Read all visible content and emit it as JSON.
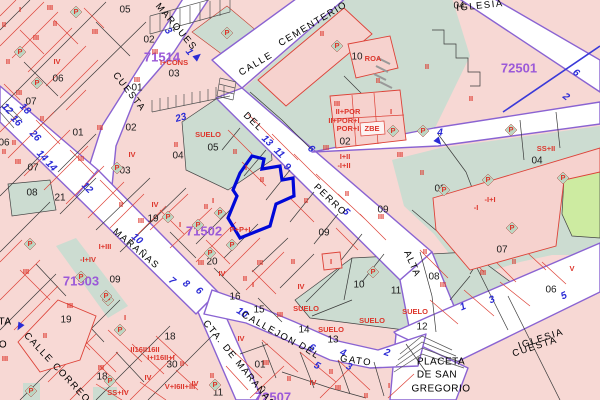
{
  "map": {
    "colors": {
      "parcel_pink": "#f7d8d4",
      "building_pink": "#f6d2ce",
      "parcel_green": "#ccdcd1",
      "bright_green": "#cdeba1",
      "street_white": "#ffffff",
      "street_purple": "#8a63d2",
      "line_red": "#dd4238",
      "line_black": "#3a3a3a",
      "portal_blue": "#2b2bd5",
      "block_purple": "#9b59d8",
      "selected_blue": "#0008d8",
      "label_red": "#dd362c",
      "label_black": "#1c1c1c"
    },
    "selected_parcel": {
      "number": "07"
    },
    "block_ids": [
      [
        "71514",
        162,
        58
      ],
      [
        "72501",
        519,
        69
      ],
      [
        "71502",
        204,
        232
      ],
      [
        "71503",
        81,
        282
      ],
      [
        "72507",
        273,
        398
      ]
    ],
    "street_names": [
      [
        "MARQUES",
        176,
        27,
        50,
        3
      ],
      [
        "CALLE",
        256,
        64,
        -31,
        2
      ],
      [
        "CEMENTERIO",
        313,
        24,
        -31,
        2
      ],
      [
        "CUESTA",
        129,
        92,
        52,
        1
      ],
      [
        "DEL",
        253,
        122,
        44,
        1
      ],
      [
        "PERRO",
        330,
        200,
        44,
        1
      ],
      [
        "MARAÑAS",
        136,
        249,
        40,
        1
      ],
      [
        "CALLE CORREO",
        57,
        368,
        47,
        1
      ],
      [
        "CALLEJON",
        269,
        329,
        29,
        1
      ],
      [
        "DEL",
        309,
        351,
        33,
        1
      ],
      [
        "GATO",
        356,
        361,
        8,
        1
      ],
      [
        "CTA. DE MARAÑAS",
        239,
        364,
        51,
        0
      ],
      [
        "ALTA",
        412,
        264,
        66,
        1
      ],
      [
        "CUESTA",
        535,
        347,
        -18,
        1
      ],
      [
        "IGLESIA",
        541,
        339,
        -18,
        0
      ],
      [
        "IGLESIA",
        480,
        6,
        -6,
        1
      ]
    ],
    "place_labels": [
      [
        "PLACETA",
        441,
        362
      ],
      [
        "DE SAN",
        437,
        375
      ],
      [
        "GREGORIO",
        441,
        389
      ],
      [
        "TA",
        5,
        322
      ],
      [
        "O",
        3,
        345
      ]
    ],
    "parcel_numbers": [
      [
        "05",
        125,
        10
      ],
      [
        "02",
        149,
        40
      ],
      [
        "03",
        174,
        74
      ],
      [
        "01",
        137,
        88
      ],
      [
        "06",
        58,
        79
      ],
      [
        "07",
        31,
        102
      ],
      [
        "06",
        4,
        143
      ],
      [
        "07",
        33,
        168
      ],
      [
        "01",
        78,
        133
      ],
      [
        "02",
        131,
        128
      ],
      [
        "03",
        125,
        171
      ],
      [
        "04",
        178,
        156
      ],
      [
        "08",
        32,
        193
      ],
      [
        "21",
        60,
        198
      ],
      [
        "19",
        153,
        219
      ],
      [
        "04",
        459,
        6
      ],
      [
        "10",
        357,
        57
      ],
      [
        "02",
        345,
        142
      ],
      [
        "03",
        440,
        189
      ],
      [
        "04",
        537,
        161
      ],
      [
        "07",
        502,
        250
      ],
      [
        "08",
        434,
        277
      ],
      [
        "06",
        551,
        290
      ],
      [
        "12",
        422,
        327
      ],
      [
        "09",
        115,
        280
      ],
      [
        "09",
        324,
        233
      ],
      [
        "09",
        383,
        210
      ],
      [
        "20",
        212,
        262
      ],
      [
        "16",
        235,
        297
      ],
      [
        "15",
        259,
        310
      ],
      [
        "14",
        304,
        330
      ],
      [
        "13",
        333,
        340
      ],
      [
        "10",
        359,
        285
      ],
      [
        "11",
        396,
        291
      ],
      [
        "01",
        260,
        365
      ],
      [
        "19",
        66,
        320
      ],
      [
        "18",
        102,
        377
      ],
      [
        "18",
        170,
        337
      ],
      [
        "30",
        172,
        365
      ],
      [
        "11",
        218,
        393
      ],
      [
        "05",
        213,
        148
      ]
    ],
    "street_numbers": [
      [
        "3",
        168,
        31,
        50
      ],
      [
        "1",
        189,
        52,
        50
      ],
      [
        "23",
        181,
        118,
        -15
      ],
      [
        "12",
        7,
        109,
        45
      ],
      [
        "18",
        25,
        109,
        45
      ],
      [
        "16",
        16,
        121,
        45
      ],
      [
        "26",
        35,
        136,
        45
      ],
      [
        "14",
        42,
        156,
        45
      ],
      [
        "14",
        51,
        166,
        45
      ],
      [
        "12",
        87,
        188,
        45
      ],
      [
        "13",
        267,
        141,
        44
      ],
      [
        "11",
        279,
        153,
        44
      ],
      [
        "9",
        287,
        167,
        44
      ],
      [
        "6",
        311,
        149,
        44
      ],
      [
        "5",
        346,
        212,
        44
      ],
      [
        "4",
        440,
        133,
        0
      ],
      [
        "6",
        576,
        73,
        38
      ],
      [
        "2",
        566,
        97,
        38
      ],
      [
        "10",
        137,
        239,
        40
      ],
      [
        "7",
        172,
        281,
        40
      ],
      [
        "8",
        186,
        284,
        40
      ],
      [
        "6",
        199,
        291,
        40
      ],
      [
        "10",
        242,
        313,
        32
      ],
      [
        "6",
        312,
        348,
        28
      ],
      [
        "5",
        317,
        366,
        28
      ],
      [
        "4",
        343,
        353,
        22
      ],
      [
        "3",
        349,
        367,
        22
      ],
      [
        "2",
        387,
        353,
        18
      ],
      [
        "1",
        463,
        307,
        -22
      ],
      [
        "3",
        492,
        300,
        -22
      ],
      [
        "5",
        564,
        296,
        -25
      ]
    ],
    "building_labels": [
      [
        "I",
        20,
        10
      ],
      [
        "III",
        50,
        8
      ],
      [
        "II",
        4,
        25
      ],
      [
        "II",
        55,
        24
      ],
      [
        "III",
        36,
        38
      ],
      [
        "III",
        95,
        32
      ],
      [
        "II",
        8,
        62
      ],
      [
        "IV",
        57,
        62
      ],
      [
        "P",
        76,
        12
      ],
      [
        "P",
        20,
        52
      ],
      [
        "P",
        37,
        83
      ],
      [
        "III",
        19,
        93
      ],
      [
        "II",
        42,
        119
      ],
      [
        "III",
        100,
        128
      ],
      [
        "II",
        14,
        143
      ],
      [
        "II",
        4,
        152
      ],
      [
        "III",
        18,
        162
      ],
      [
        "III",
        81,
        159
      ],
      [
        "IV",
        132,
        155
      ],
      [
        "P",
        117,
        168
      ],
      [
        "III",
        155,
        52
      ],
      [
        "I+CONS",
        174,
        63
      ],
      [
        "III",
        137,
        80
      ],
      [
        "P",
        227,
        33
      ],
      [
        "II",
        322,
        34
      ],
      [
        "P",
        337,
        46
      ],
      [
        "ROA",
        373,
        59
      ],
      [
        "II",
        378,
        81
      ],
      [
        "II",
        427,
        67
      ],
      [
        "II",
        471,
        99
      ],
      [
        "III",
        337,
        104
      ],
      [
        "II+POR",
        348,
        112
      ],
      [
        "II+POR+I",
        344,
        121
      ],
      [
        "POR+I",
        348,
        129
      ],
      [
        "ZBE",
        372,
        129,
        6
      ],
      [
        "P",
        393,
        131
      ],
      [
        "I",
        391,
        112
      ],
      [
        "I+II",
        345,
        157
      ],
      [
        "-I+II",
        344,
        166
      ],
      [
        "III",
        326,
        148
      ],
      [
        "III",
        400,
        155
      ],
      [
        "II",
        422,
        173
      ],
      [
        "SUELO",
        208,
        135
      ],
      [
        "II",
        176,
        145
      ],
      [
        "II",
        235,
        152
      ],
      [
        "I",
        246,
        168
      ],
      [
        "II",
        262,
        180
      ],
      [
        "II",
        306,
        201
      ],
      [
        "II",
        347,
        194
      ],
      [
        "I",
        213,
        201
      ],
      [
        "P",
        220,
        213
      ],
      [
        "P",
        198,
        225
      ],
      [
        "P+P+I",
        240,
        230
      ],
      [
        "P",
        232,
        245
      ],
      [
        "P",
        210,
        253
      ],
      [
        "II",
        121,
        205
      ],
      [
        "IV",
        155,
        205
      ],
      [
        "II",
        206,
        207
      ],
      [
        "III",
        141,
        221
      ],
      [
        "P",
        168,
        217
      ],
      [
        "I",
        180,
        225
      ],
      [
        "III",
        201,
        263
      ],
      [
        "III",
        260,
        263
      ],
      [
        "IV",
        222,
        274
      ],
      [
        "II",
        245,
        279
      ],
      [
        "I",
        253,
        285
      ],
      [
        "I+III",
        105,
        247
      ],
      [
        "-I+IV",
        88,
        260
      ],
      [
        "III",
        26,
        272
      ],
      [
        "III",
        70,
        306
      ],
      [
        "P",
        30,
        244
      ],
      [
        "P",
        81,
        277
      ],
      [
        "P",
        108,
        300
      ],
      [
        "I",
        125,
        318
      ],
      [
        "P",
        120,
        330
      ],
      [
        "II",
        45,
        336
      ],
      [
        "III",
        101,
        368
      ],
      [
        "P",
        110,
        381
      ],
      [
        "SS+IV",
        118,
        393,
        6
      ],
      [
        "IV",
        148,
        378
      ],
      [
        "II16II16II",
        145,
        350,
        5
      ],
      [
        "I+I16II+I",
        161,
        358,
        5
      ],
      [
        "V+I6II+III",
        180,
        387,
        5
      ],
      [
        "II",
        182,
        364
      ],
      [
        "P",
        106,
        296
      ],
      [
        "P",
        31,
        391
      ],
      [
        "III",
        5,
        359
      ],
      [
        "II",
        293,
        262
      ],
      [
        "I",
        331,
        262
      ],
      [
        "IV",
        301,
        287
      ],
      [
        "III",
        280,
        315
      ],
      [
        "SUELO",
        306,
        309
      ],
      [
        "SUELO",
        331,
        330
      ],
      [
        "SUELO",
        372,
        321
      ],
      [
        "SUELO",
        415,
        312
      ],
      [
        "P",
        373,
        272
      ],
      [
        "III",
        266,
        363
      ],
      [
        "IV",
        241,
        339
      ],
      [
        "II",
        212,
        376
      ],
      [
        "IV",
        195,
        384
      ],
      [
        "P",
        215,
        385
      ],
      [
        "II",
        289,
        379
      ],
      [
        "IV",
        313,
        383
      ],
      [
        "III",
        338,
        388
      ],
      [
        "II",
        366,
        396
      ],
      [
        "I",
        389,
        386
      ],
      [
        "II",
        331,
        372
      ],
      [
        "III",
        381,
        217
      ],
      [
        "II",
        425,
        252
      ],
      [
        "III",
        443,
        285
      ],
      [
        "III",
        483,
        273
      ],
      [
        "II",
        514,
        262
      ],
      [
        "V",
        572,
        269
      ],
      [
        "-I",
        476,
        208,
        6
      ],
      [
        "-I+I",
        490,
        200,
        6
      ],
      [
        "P",
        444,
        190
      ],
      [
        "P",
        488,
        180
      ],
      [
        "P",
        511,
        130
      ],
      [
        "P",
        563,
        178
      ],
      [
        "P",
        512,
        228
      ],
      [
        "SS+II",
        546,
        149
      ],
      [
        "P",
        423,
        131
      ]
    ],
    "arrows": [
      [
        197,
        57,
        50
      ],
      [
        438,
        141,
        140
      ],
      [
        20,
        326,
        210
      ]
    ]
  }
}
